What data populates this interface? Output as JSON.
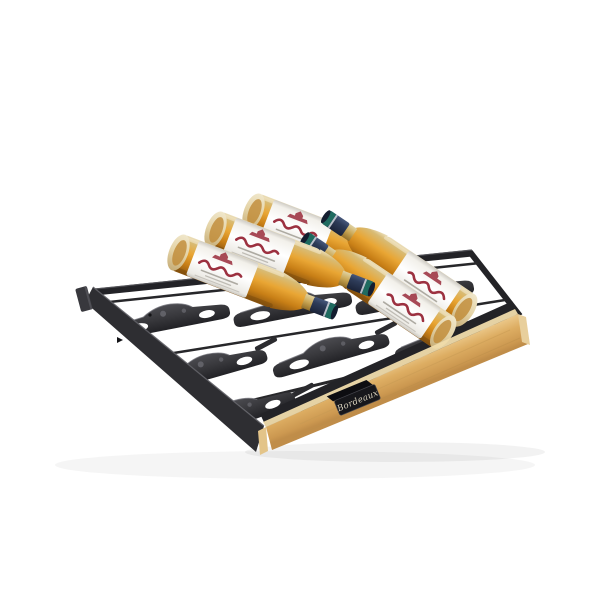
{
  "page": {
    "background": "#ffffff"
  },
  "product": {
    "name": "wine-cellar-sliding-shelf",
    "description": "Black sliding shelf with molded bottle supports and a light wooden front trim, holding five Bordeaux-style wine bottles lying head-to-toe",
    "bottle_count": 5,
    "bottles_neck_forward": 3,
    "bottles_neck_backward": 2
  },
  "front_plaque": {
    "label": "Bordeaux"
  },
  "bottle_label": {
    "illustration": "chateau-illustration",
    "script_color": "#9c3140"
  },
  "colors": {
    "background": "#ffffff",
    "frame": "#2e2e32",
    "frameDark": "#232327",
    "frameLight": "#5c5c62",
    "wood": "#ddad62",
    "woodLight": "#ecc98b",
    "woodDark": "#c08d49",
    "woodBevel": "#f0dcab",
    "plaque": "#17171b",
    "plaqueText": "#d8d1bd",
    "glassAmber": "#e5a02f",
    "glassDark": "#8f5a12",
    "glassPale": "#eee3c2",
    "labelWhite": "#f8f6f1",
    "labelRed": "#9c3140",
    "capNavy": "#2c3a56",
    "capTeal": "#1f6b60",
    "capSilver": "#c9ced6"
  }
}
